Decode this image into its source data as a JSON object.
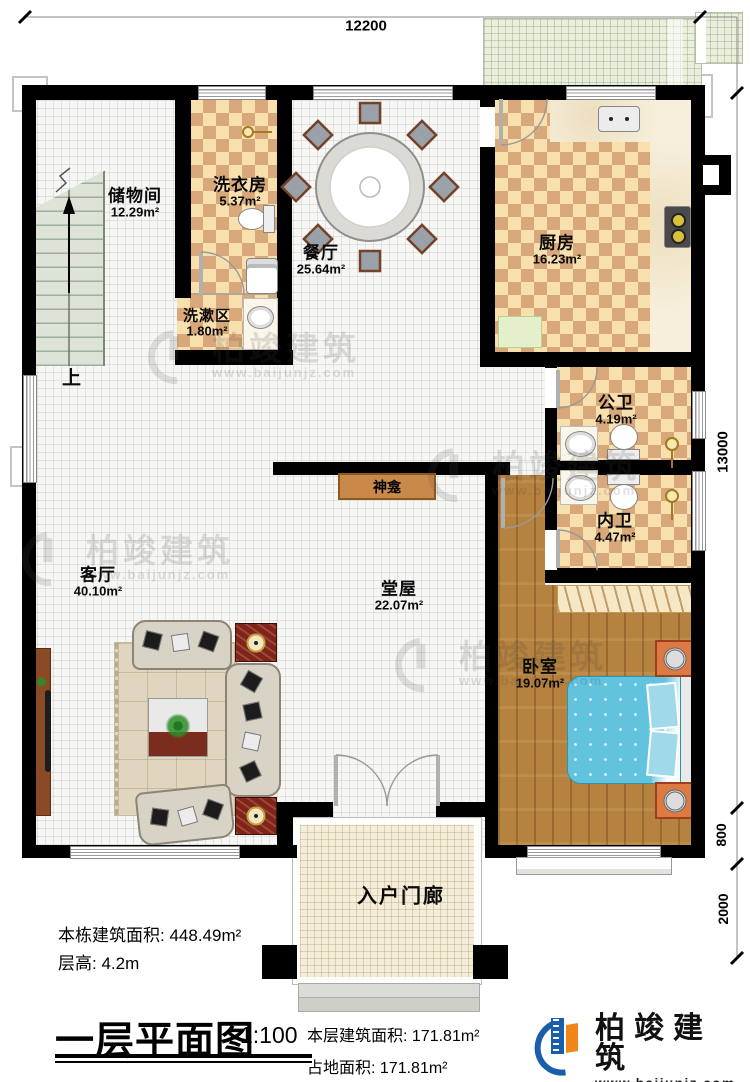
{
  "title": {
    "text": "一层平面图",
    "scale": "1:100"
  },
  "dimensions": {
    "top": "12200",
    "right_total": "13000",
    "right_bay": "800",
    "right_porch": "2000"
  },
  "rooms": [
    {
      "name": "储物间",
      "area": "12.29m²"
    },
    {
      "name": "洗衣房",
      "area": "5.37m²"
    },
    {
      "name": "餐厅",
      "area": "25.64m²"
    },
    {
      "name": "厨房",
      "area": "16.23m²"
    },
    {
      "name": "洗漱区",
      "area": "1.80m²"
    },
    {
      "name": "公卫",
      "area": "4.19m²"
    },
    {
      "name": "内卫",
      "area": "4.47m²"
    },
    {
      "name": "客厅",
      "area": "40.10m²"
    },
    {
      "name": "堂屋",
      "area": "22.07m²"
    },
    {
      "name": "卧室",
      "area": "19.07m²"
    },
    {
      "name": "入户门廊",
      "area": ""
    }
  ],
  "features": {
    "shrine": "神龛",
    "stairs_up": "上"
  },
  "info": {
    "total_area_label": "本栋建筑面积:",
    "total_area_value": "448.49m²",
    "floor_height_label": "层高:",
    "floor_height_value": "4.2m",
    "floor_area_label": "本层建筑面积:",
    "floor_area_value": "171.81m²",
    "footprint_label": "占地面积:",
    "footprint_value": "171.81m²"
  },
  "branding": {
    "company": "柏竣建筑",
    "website": "www.baijunjz.com",
    "blue": "#1a5dab",
    "orange": "#f08519"
  }
}
